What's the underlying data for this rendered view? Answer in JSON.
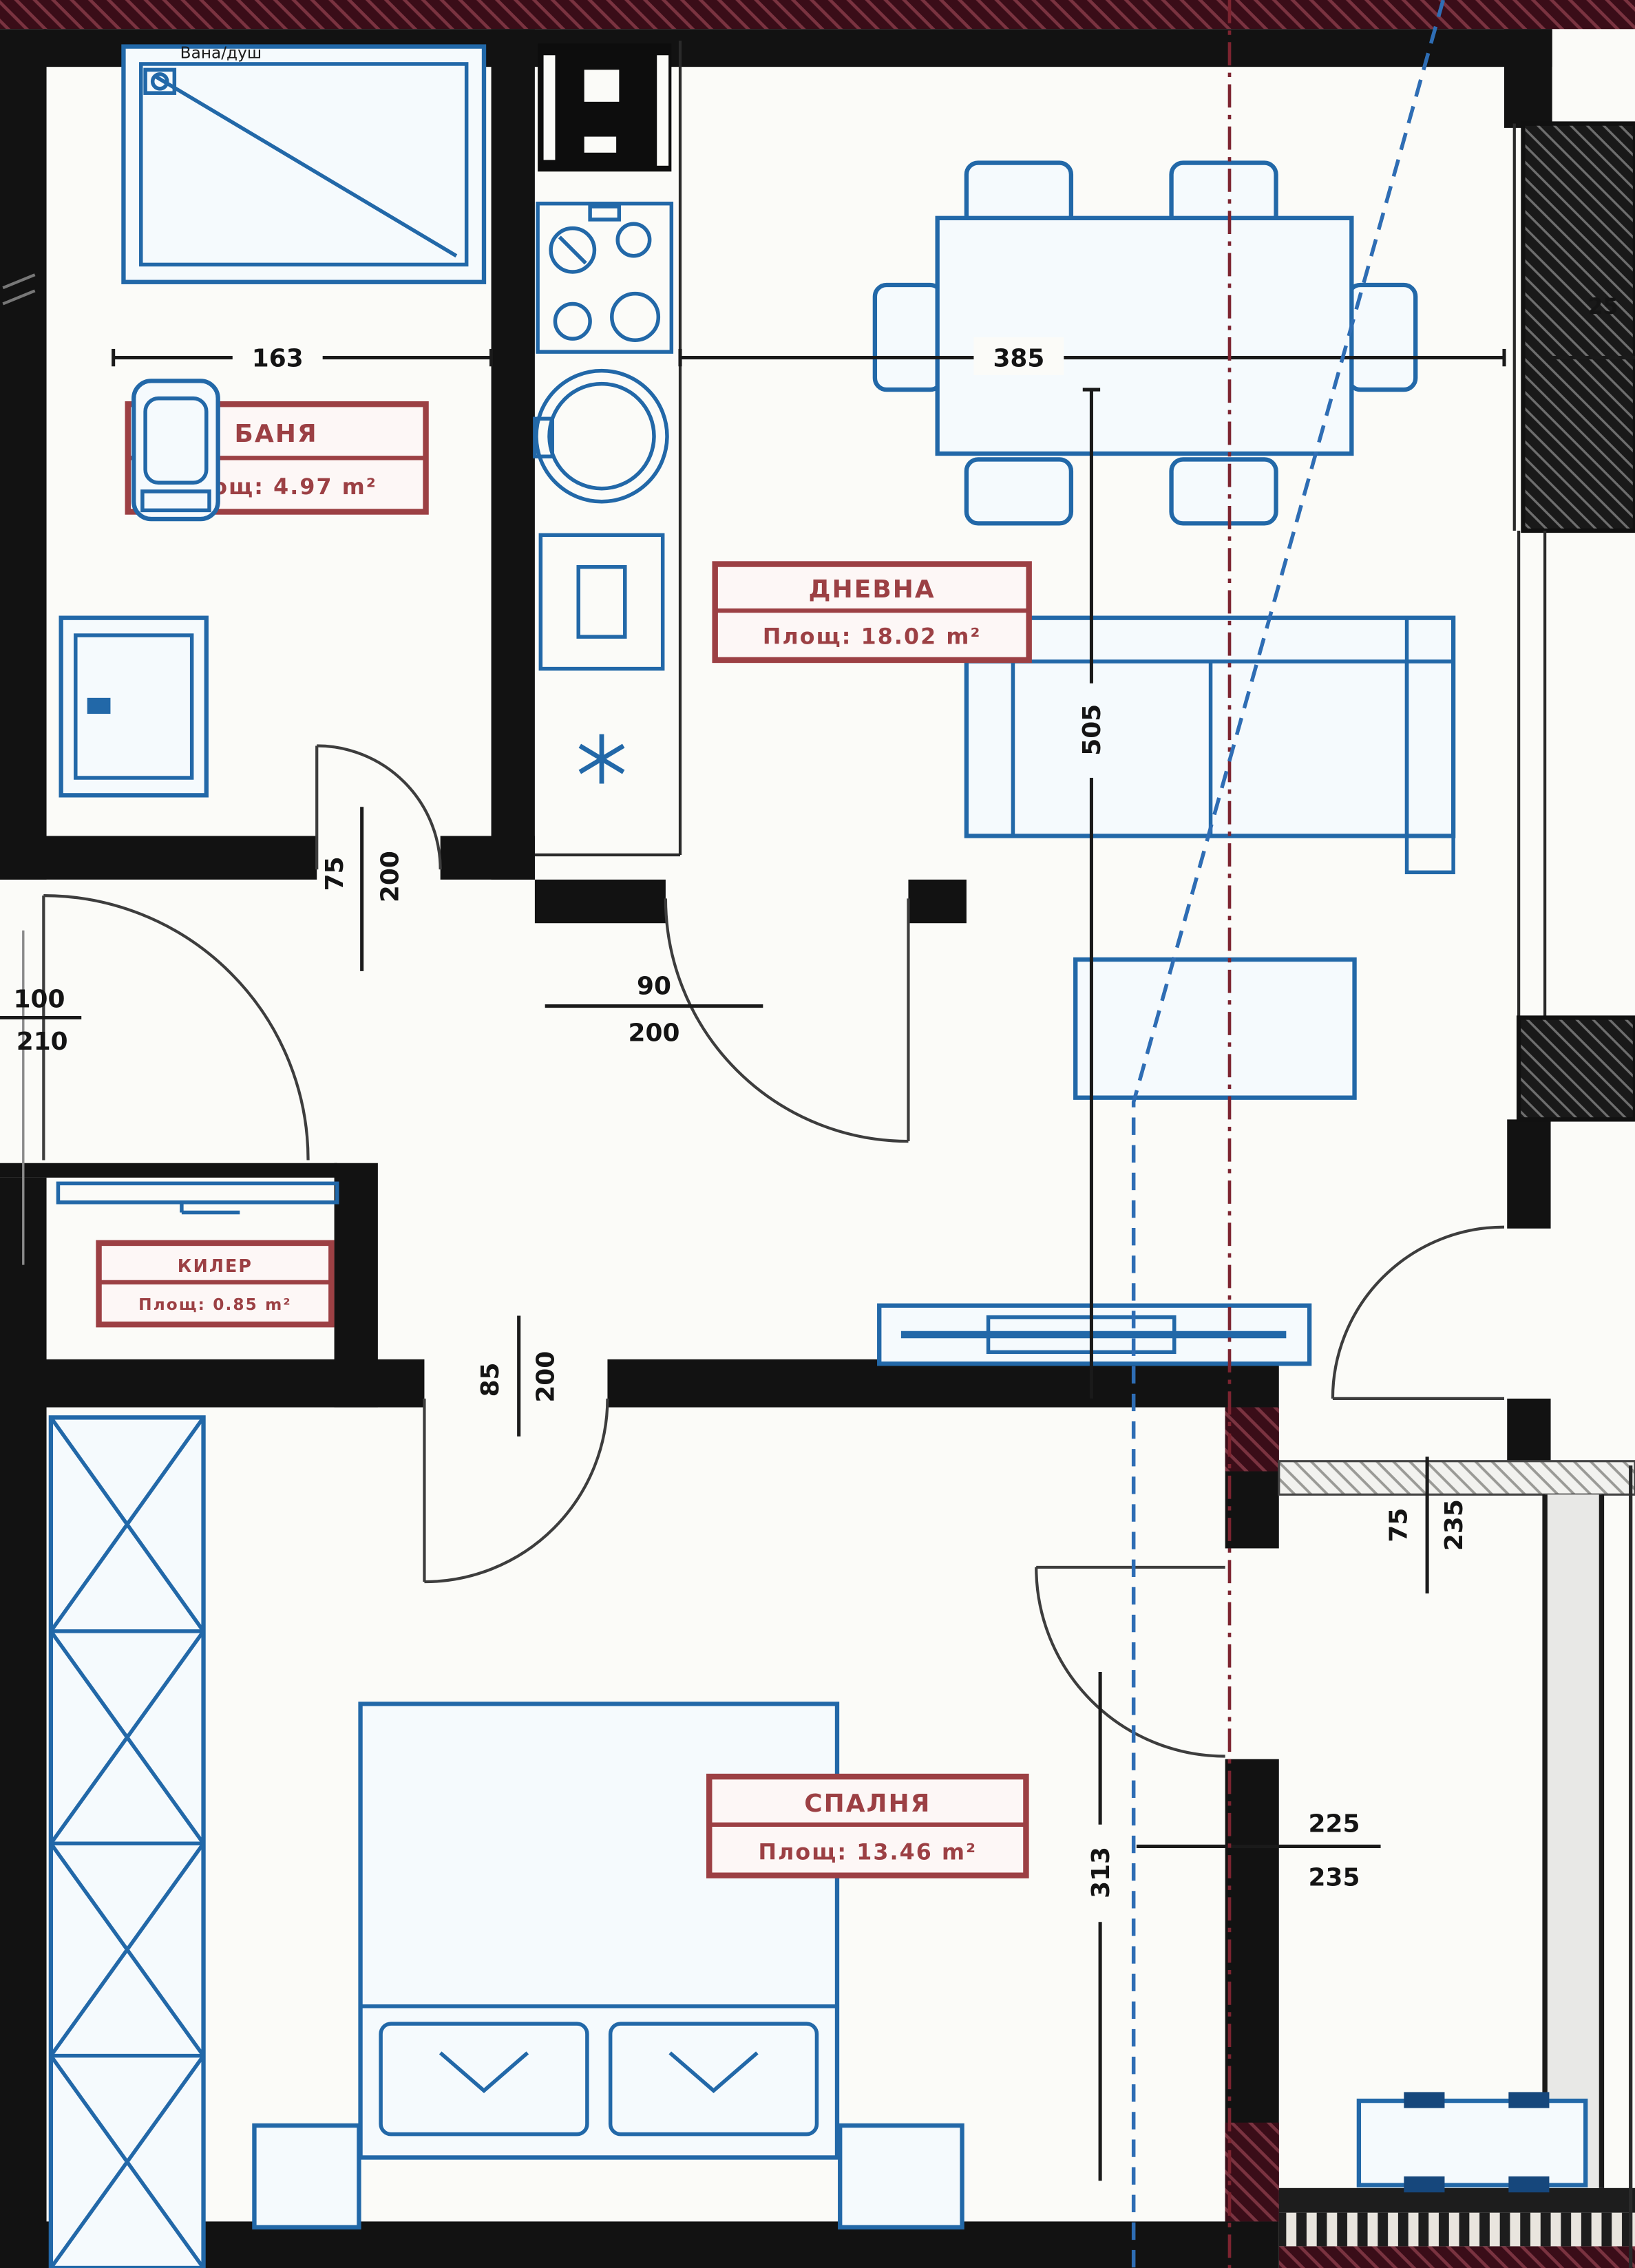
{
  "plan": {
    "bath_note": "Вана/душ",
    "rooms": {
      "bath": {
        "name": "БАНЯ",
        "area": "Площ: 4.97 m²"
      },
      "living": {
        "name": "ДНЕВНА",
        "area": "Площ: 18.02 m²"
      },
      "closet": {
        "name": "КИЛЕР",
        "area": "Площ: 0.85 m²"
      },
      "bedroom": {
        "name": "СПАЛНЯ",
        "area": "Площ: 13.46 m²"
      }
    },
    "dims": {
      "bath_width": "163",
      "living_width": "385",
      "right_top": "25",
      "living_depth": "505",
      "bedroom_depth": "313",
      "balcony_win_w": "225",
      "balcony_win_h": "235",
      "bath_door_w": "75",
      "bath_door_h": "200",
      "entry_w": "100",
      "entry_h": "210",
      "living_door_w": "90",
      "living_door_h": "200",
      "bedroom_door_w": "85",
      "bedroom_door_h": "200",
      "balcony_door_w": "75",
      "balcony_door_h": "235"
    },
    "colors": {
      "wall": "#121212",
      "furniture_blue": "#2268a8",
      "label_red": "#9c4044",
      "axis_red": "#7d2430",
      "guide_blue": "#2e6db4",
      "slab_maroon": "#3a0d18"
    }
  }
}
